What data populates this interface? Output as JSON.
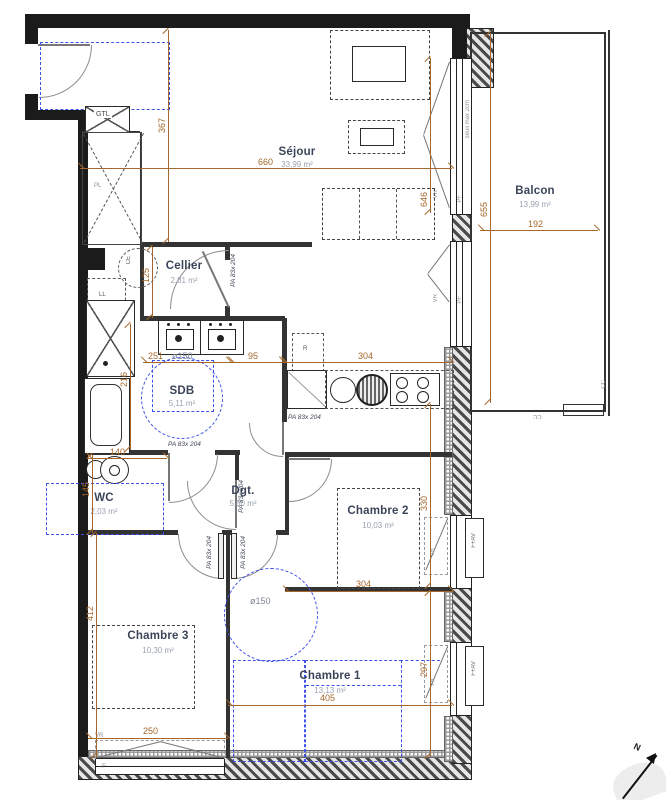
{
  "plan": {
    "rooms": {
      "sejour": {
        "name": "Séjour",
        "area": "33,99 m²"
      },
      "balcon": {
        "name": "Balcon",
        "area": "13,99 m²"
      },
      "cellier": {
        "name": "Cellier",
        "area": "2,81 m²"
      },
      "sdb": {
        "name": "SDB",
        "area": "5,11 m²"
      },
      "wc": {
        "name": "WC",
        "area": "2,03 m²"
      },
      "dgt": {
        "name": "Dgt.",
        "area": "5,50 m²"
      },
      "chambre2": {
        "name": "Chambre 2",
        "area": "10,03 m²"
      },
      "chambre3": {
        "name": "Chambre 3",
        "area": "10,30 m²"
      },
      "chambre1": {
        "name": "Chambre 1",
        "area": "13,13 m²"
      }
    },
    "dims": {
      "sejour_w": "660",
      "entry_h": "367",
      "sejour_win_h": "646",
      "balcon_h": "655",
      "balcon_w": "192",
      "cellier_h": "125",
      "sdb_w": "251",
      "sdb_pass": "95",
      "kitchen_w": "304",
      "sdb_h": "216",
      "wc_w": "140",
      "wc_h": "145",
      "ch2_h": "330",
      "ch2_w": "304",
      "ch3_h": "412",
      "ch3_w": "250",
      "ch1_w": "405",
      "ch1_h": "297",
      "turn_circle": "ø150"
    },
    "labels": {
      "door": "PA 83x 204",
      "gtl": "GTL",
      "pl": "PL",
      "ll": "LL",
      "ce": "CE",
      "fridge": "R",
      "vr": "VR",
      "pf": "PF",
      "fav": "F+AV",
      "f": "F",
      "seuil": "seuil max 2cm",
      "cc": "CC",
      "north": "N"
    },
    "colors": {
      "wall": "#1b1b1b",
      "dimension": "#a5682a",
      "furniture": "#3d52e8"
    }
  }
}
